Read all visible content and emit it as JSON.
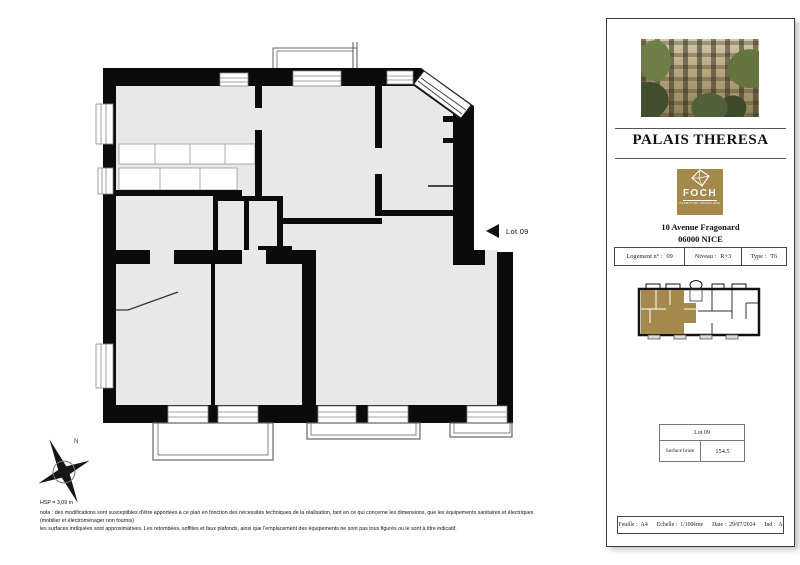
{
  "colors": {
    "gold": "#a5894c",
    "plan_fill": "#e8e8e8",
    "wall": "#0b0b0b",
    "panel_border": "#3a3a3a"
  },
  "plan": {
    "lot_label": "Lot 09",
    "hsp": "HSP = 3,09 m",
    "nota_line1": "nota : des modifications sont susceptibles d'être apportées à ce plan en fonction des nécessités techniques de la réalisation, tant en ce qui concerne les dimensions, que les équipements sanitaires et électriques (mobilier et électroménager non fournis)",
    "nota_line2": "les surfaces indiquées sont approximatives. Les retombées, soffites et faux plafonds, ainsi que l'emplacement des équipements ne sont pas tous figurés ou le sont à titre indicatif.",
    "north_label": "N"
  },
  "panel": {
    "title": "PALAIS THERESA",
    "logo": {
      "name": "FOCH",
      "tagline": "PROMOTION IMMOBILIÈRE"
    },
    "address_line1": "10 Avenue Fragonard",
    "address_line2": "06000 NICE",
    "info": {
      "logement_label": "Logement n° :",
      "logement_value": "09",
      "niveau_label": "Niveau :",
      "niveau_value": "R+3",
      "type_label": "Type :",
      "type_value": "T6"
    },
    "lot_table": {
      "header": "Lot 09",
      "surface_label": "Surface brute",
      "surface_value": "154.5"
    },
    "footer": {
      "feuille_label": "Feuille :",
      "feuille_value": "A4",
      "echelle_label": "Echelle :",
      "echelle_value": "1/100ème",
      "date_label": "Date :",
      "date_value": "29/07/2024",
      "ind_label": "Ind :",
      "ind_value": "A"
    }
  }
}
